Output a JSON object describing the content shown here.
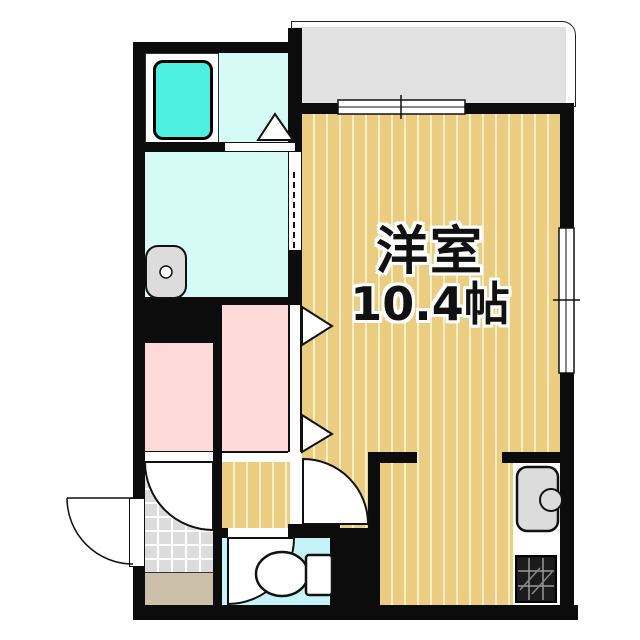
{
  "floorplan": {
    "room_label": "洋室",
    "room_size_label": "10.4帖"
  },
  "colors": {
    "wall": "#0c0c0c",
    "flooring": "#eacd80",
    "flooring_stripe": "#f8edc9",
    "balcony": "#e1e1e1",
    "closet_pink": "#fdd9da",
    "bath_aqua": "#d6faf5",
    "tub_cyan": "#4df0e0",
    "toilet_aqua": "#c6f3f8",
    "tile_gray": "#dcdcdc",
    "step_beige": "#ccc0ab",
    "fixture_gray": "#dcdcdc",
    "line": "#111111"
  }
}
